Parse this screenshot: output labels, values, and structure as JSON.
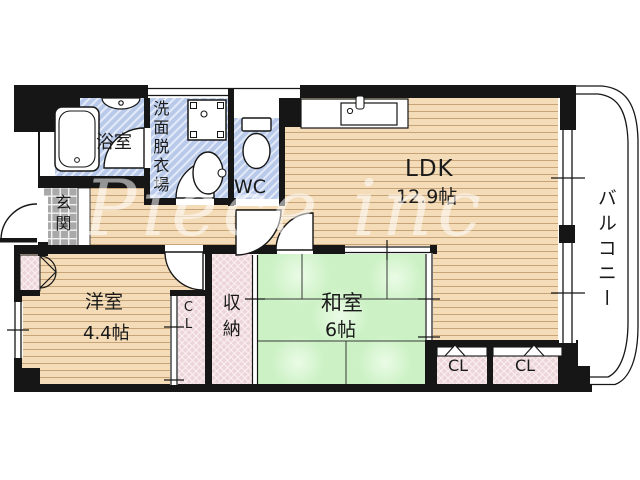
{
  "watermark": "Piece inc",
  "rooms": {
    "bathroom": {
      "name": "浴室"
    },
    "washroom": {
      "name": "洗面脱衣場"
    },
    "toilet": {
      "name": "WC"
    },
    "ldk": {
      "name": "LDK",
      "size": "12.9帖"
    },
    "balcony": {
      "name": "バルコニー"
    },
    "entrance": {
      "name": "玄関"
    },
    "western_room": {
      "name": "洋室",
      "size": "4.4帖"
    },
    "closet_west": {
      "name": "CL"
    },
    "storage": {
      "name": "収納"
    },
    "japanese_room": {
      "name": "和室",
      "size": "6帖"
    },
    "closet_south_1": {
      "name": "CL"
    },
    "closet_south_2": {
      "name": "CL"
    }
  },
  "colors": {
    "wall": "#161616",
    "wet_area": "#b9c9ea",
    "wood_floor": "#f4dcb9",
    "tatami": "#cbf1c4",
    "closet": "#edd6da",
    "entrance_tile": "#a9a9a9"
  }
}
